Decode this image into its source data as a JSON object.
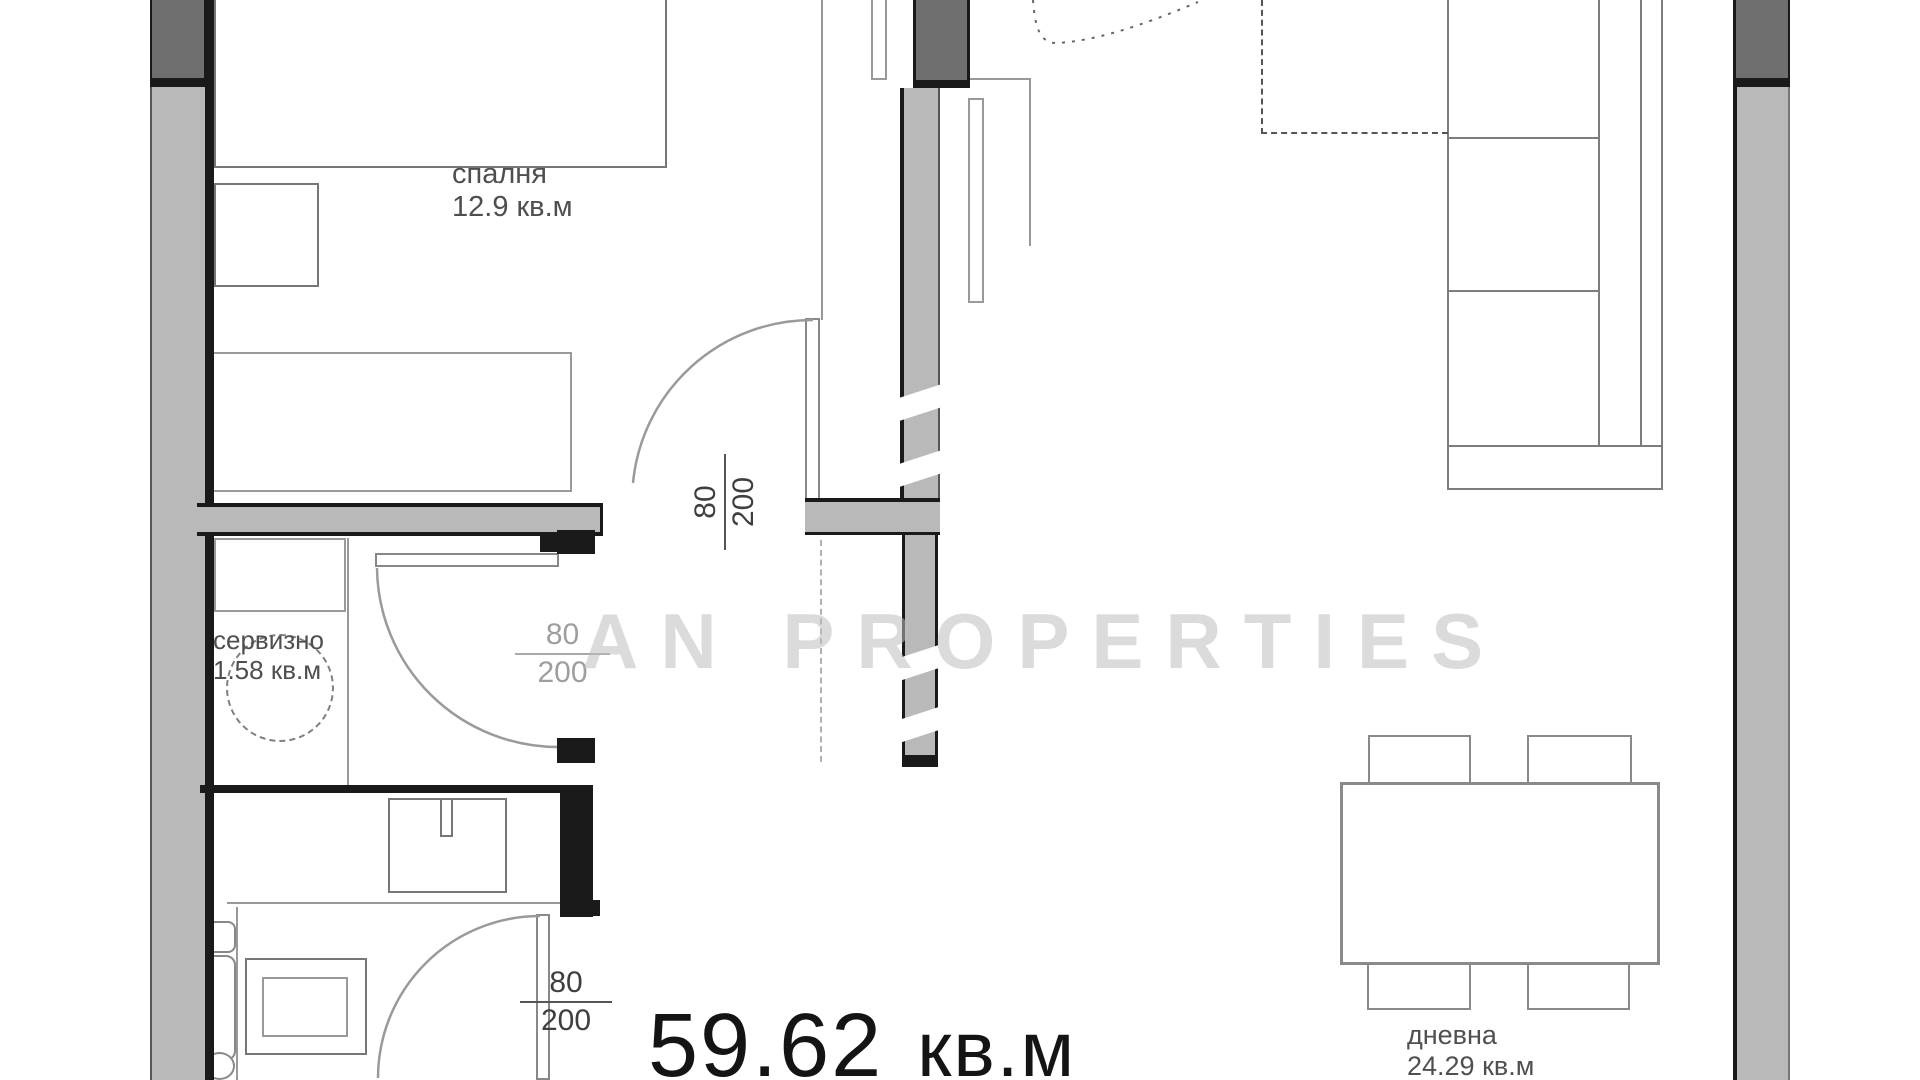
{
  "floorplan": {
    "watermark": "AN PROPERTIES",
    "total_area": {
      "value": "59.62",
      "unit": "кв.м"
    },
    "rooms": {
      "bedroom": {
        "name": "спалня",
        "area": "12.9 кв.м"
      },
      "service": {
        "name": "сервизно",
        "area": "1.58 кв.м"
      },
      "living": {
        "name": "дневна",
        "area": "24.29 кв.м"
      }
    },
    "doors": {
      "bedroom": {
        "width": "80",
        "height": "200"
      },
      "lobby": {
        "width": "80",
        "height": "200"
      },
      "bathroom": {
        "width": "80",
        "height": "200"
      }
    },
    "colors": {
      "wall_fill": "#b9b9b9",
      "wall_dark": "#6f6f6f",
      "outline": "#1a1a1a",
      "furniture_line": "#8a8a8a",
      "label_text": "#4f4f4f",
      "area_text": "#141414",
      "watermark_text": "#bdbdbd"
    }
  }
}
